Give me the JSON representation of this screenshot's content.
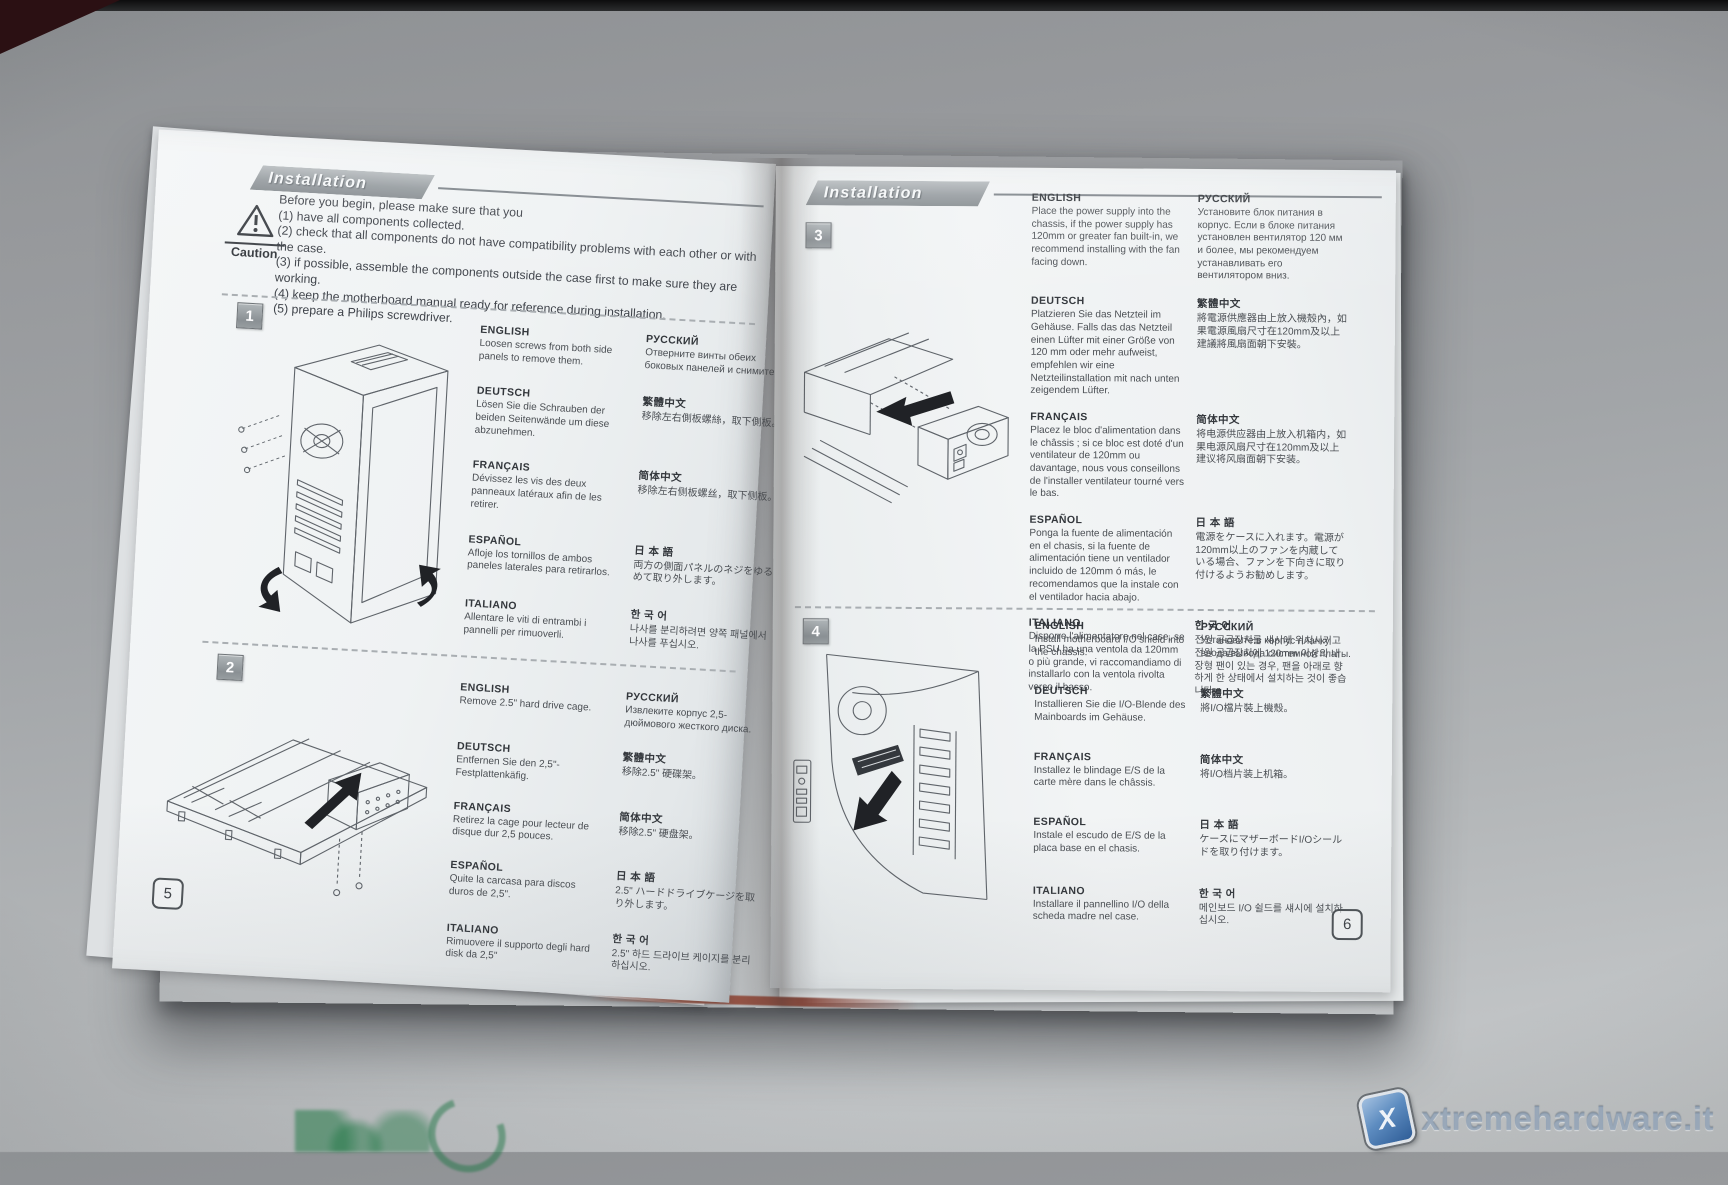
{
  "colors": {
    "banner_gray": "#8b9194",
    "logo_blue": "#3c6ca8",
    "paper_white": "#eef1f2",
    "surface_gray": "#a8abae"
  },
  "icons": {
    "caution": "warning-triangle-icon",
    "watermark_logo": "xtremehardware-x-logo-icon"
  },
  "watermark": {
    "text": "xtremehardware.it",
    "logo_letter": "X"
  },
  "left_page": {
    "page_number": "5",
    "header_title": "Installation Guide",
    "caution": {
      "label": "Caution",
      "intro": "Before you begin, please make sure that you",
      "items": [
        "(1) have all components collected.",
        "(2) check that all components do not have compatibility problems with each other or with the case.",
        "(3) if possible, assemble the components outside the case first to make sure they are working.",
        "(4) keep the motherboard manual ready for reference during installation.",
        "(5) prepare a Philips screwdriver."
      ]
    },
    "steps": [
      {
        "number": "1",
        "illustration": "tower-case-side-panels-drawing",
        "blocks": [
          {
            "lang": "ENGLISH",
            "text": "Loosen screws from both side panels to remove them."
          },
          {
            "lang": "РУССКИЙ",
            "text": "Отверните винты обеих боковых панелей и снимите их."
          },
          {
            "lang": "DEUTSCH",
            "text": "Lösen Sie die Schrauben der beiden Seitenwände um diese abzunehmen."
          },
          {
            "lang": "繁體中文",
            "text": "移除左右側板螺絲，取下側板。"
          },
          {
            "lang": "FRANÇAIS",
            "text": "Dévissez les vis des deux panneaux latéraux afin de les retirer."
          },
          {
            "lang": "简体中文",
            "text": "移除左右侧板螺丝，取下侧板。"
          },
          {
            "lang": "ESPAÑOL",
            "text": "Afloje los tornillos de ambos paneles laterales para retirarlos."
          },
          {
            "lang": "日 本 語",
            "text": "両方の側面パネルのネジをゆるめて取り外します。"
          },
          {
            "lang": "ITALIANO",
            "text": "Allentare le viti di entrambi i pannelli per rimuoverli."
          },
          {
            "lang": "한 국 어",
            "text": "나사를 분리하려면 양쪽 패널에서 나사를 푸십시오."
          }
        ]
      },
      {
        "number": "2",
        "illustration": "hard-drive-cage-removal-drawing",
        "blocks": [
          {
            "lang": "ENGLISH",
            "text": "Remove 2.5\" hard drive cage."
          },
          {
            "lang": "РУССКИЙ",
            "text": "Извлеките корпус 2,5-дюймового жесткого диска."
          },
          {
            "lang": "DEUTSCH",
            "text": "Entfernen Sie den 2,5\"-Festplattenkäfig."
          },
          {
            "lang": "繁體中文",
            "text": "移除2.5\" 硬碟架。"
          },
          {
            "lang": "FRANÇAIS",
            "text": "Retirez la cage pour lecteur de disque dur 2,5 pouces."
          },
          {
            "lang": "简体中文",
            "text": "移除2.5\" 硬盘架。"
          },
          {
            "lang": "ESPAÑOL",
            "text": "Quite la carcasa para discos duros de 2,5\"."
          },
          {
            "lang": "日 本 語",
            "text": "2.5\" ハードドライブケージを取り外します。"
          },
          {
            "lang": "ITALIANO",
            "text": "Rimuovere il supporto degli hard disk da 2,5\""
          },
          {
            "lang": "한 국 어",
            "text": "2.5\" 하드 드라이브 케이지를 분리하십시오."
          }
        ]
      }
    ]
  },
  "right_page": {
    "page_number": "6",
    "header_title": "Installation Guide",
    "steps": [
      {
        "number": "3",
        "illustration": "power-supply-installation-drawing",
        "blocks": [
          {
            "lang": "ENGLISH",
            "text": "Place the power supply into the chassis, if the power supply has 120mm or greater fan built-in, we recommend installing with the fan facing down."
          },
          {
            "lang": "РУССКИЙ",
            "text": "Установите блок питания в корпус. Если в блоке питания установлен вентилятор 120 мм и более, мы рекомендуем устанавливать его вентилятором вниз."
          },
          {
            "lang": "DEUTSCH",
            "text": "Platzieren Sie das Netzteil im Gehäuse. Falls das das Netzteil einen Lüfter mit einer Größe von 120 mm oder mehr aufweist, empfehlen wir eine Netzteilinstallation mit nach unten zeigendem Lüfter."
          },
          {
            "lang": "繁體中文",
            "text": "將電源供應器由上放入機殼內，如果電源風扇尺寸在120mm及以上建議將風扇面朝下安裝。"
          },
          {
            "lang": "FRANÇAIS",
            "text": "Placez le bloc d'alimentation dans le châssis ; si ce bloc est doté d'un ventilateur de 120mm ou davantage, nous vous conseillons de l'installer ventilateur tourné vers le bas."
          },
          {
            "lang": "简体中文",
            "text": "将电源供应器由上放入机箱内，如果电源风扇尺寸在120mm及以上建议将风扇面朝下安装。"
          },
          {
            "lang": "ESPAÑOL",
            "text": "Ponga la fuente de alimentación en el chasis, si la fuente de alimentación tiene un ventilador incluido de 120mm ó más, le recomendamos que la instale con el ventilador hacia abajo."
          },
          {
            "lang": "日 本 語",
            "text": "電源をケースに入れます。電源が120mm以上のファンを内蔵している場合、ファンを下向きに取り付けるようお勧めします。"
          },
          {
            "lang": "ITALIANO",
            "text": "Disporre l'alimentatore nel case, se la PSU ha una ventola da 120mm o più grande, vi raccomandiamo di installarlo con la ventola rivolta verso il basso."
          },
          {
            "lang": "한 국 어",
            "text": "전원 공급장치를 섀시에 위치시키고 전원 공급장치에 120mm 이상의 내장형 팬이 있는 경우, 팬을 아래로 향하게 한 상태에서 설치하는 것이 좋습니다."
          }
        ]
      },
      {
        "number": "4",
        "illustration": "io-shield-installation-drawing",
        "blocks": [
          {
            "lang": "ENGLISH",
            "text": "Install motherboard I/O shield into the chassis."
          },
          {
            "lang": "РУССКИЙ",
            "text": "Установите в корпус планку ввода/вывода системной платы."
          },
          {
            "lang": "DEUTSCH",
            "text": "Installieren Sie die I/O-Blende des Mainboards im Gehäuse."
          },
          {
            "lang": "繁體中文",
            "text": "將I/O檔片裝上機殼。"
          },
          {
            "lang": "FRANÇAIS",
            "text": "Installez le blindage E/S de la carte mère dans le châssis."
          },
          {
            "lang": "简体中文",
            "text": "将I/O档片装上机箱。"
          },
          {
            "lang": "ESPAÑOL",
            "text": "Instale el escudo de E/S de la placa base en el chasis."
          },
          {
            "lang": "日 本 語",
            "text": "ケースにマザーボードI/Oシールドを取り付けます。"
          },
          {
            "lang": "ITALIANO",
            "text": "Installare il pannellino I/O della scheda madre nel case."
          },
          {
            "lang": "한 국 어",
            "text": "메인보드 I/O 쉴드를 섀시에 설치하십시오."
          }
        ]
      }
    ]
  }
}
